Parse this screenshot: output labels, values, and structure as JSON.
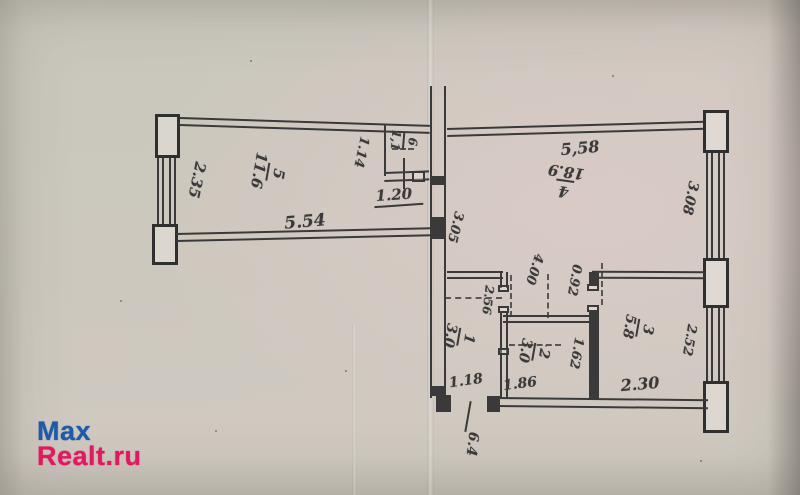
{
  "watermark": {
    "brand_part1": "Max",
    "brand_part2": "Realt.ru"
  },
  "floor_plan": {
    "rooms": [
      {
        "number": "5",
        "area": "11.6"
      },
      {
        "number": "6",
        "area": "1,1"
      },
      {
        "number": "4",
        "area": "18.9"
      },
      {
        "number": "1",
        "area": "3.0"
      },
      {
        "number": "2",
        "area": "3.0"
      },
      {
        "number": "3",
        "area": "5.8"
      }
    ],
    "dimensions": {
      "room5_width": "2.35",
      "room5_length": "5.54",
      "room6_depth": "1.14",
      "room6_width": "1.20",
      "hall_depth": "3.05",
      "room4_length": "5,58",
      "room4_width": "3.08",
      "room4_inner_length": "4.00",
      "niche_depth": "0.92",
      "room1_depth": "2.56",
      "room1_width": "1.18",
      "room2_width": "1.86",
      "room2_depth": "1.62",
      "room3_depth": "2.52",
      "room3_width": "2.30",
      "entrance_mark": "6.4"
    },
    "colors": {
      "ink": "#3a3a3a",
      "paper": "#cfc9c0",
      "watermark_blue": "#1f5aa8",
      "watermark_pink": "#e01a60"
    }
  }
}
